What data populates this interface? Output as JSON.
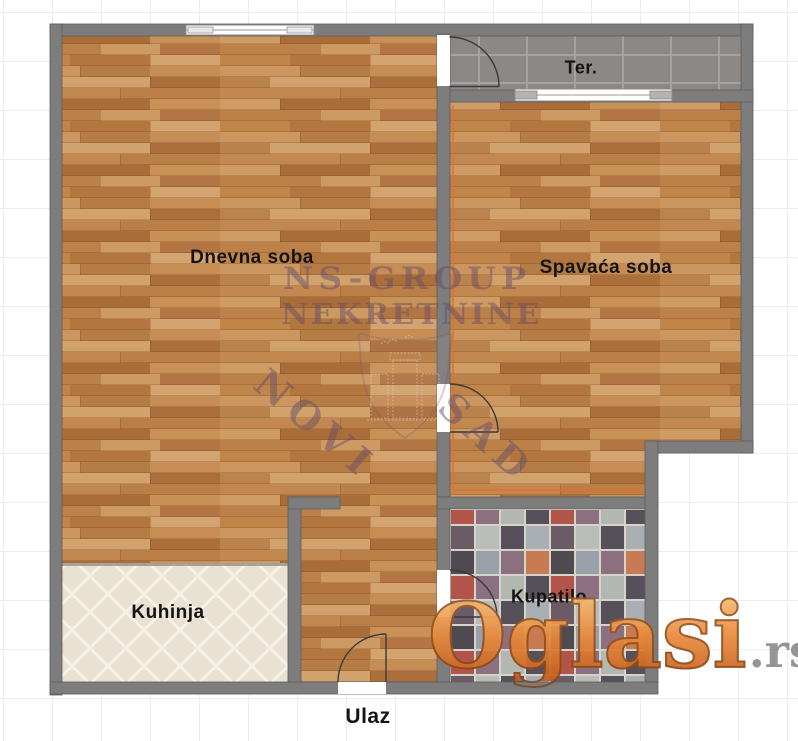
{
  "rooms": {
    "living": {
      "label": "Dnevna soba"
    },
    "bedroom": {
      "label": "Spavaća soba"
    },
    "kitchen": {
      "label": "Kuhinja"
    },
    "bathroom": {
      "label": "Kupatilo"
    },
    "terrace": {
      "label": "Ter."
    },
    "entrance": {
      "label": "Ulaz"
    }
  },
  "watermark": {
    "agency_name": "NS-GROUP",
    "agency_type": "NEKRETNINE",
    "city_word1": "NOVI",
    "city_word2": "SAD"
  },
  "brand": {
    "name": "Oglasi",
    "suffix": ".rs"
  },
  "colors": {
    "wall": "#7d7d7d",
    "wood_floor": "#c28850",
    "terrace_tile": "#8c8885",
    "kitchen_tile": "#e9e1d1",
    "bathroom_grout": "#d5d3ca",
    "highlight_orange": "#e0722c",
    "brand_orange": "#e8873c",
    "brand_suffix_gray": "#8d8d8d",
    "watermark_purple": "rgba(100,75,105,0.48)"
  }
}
